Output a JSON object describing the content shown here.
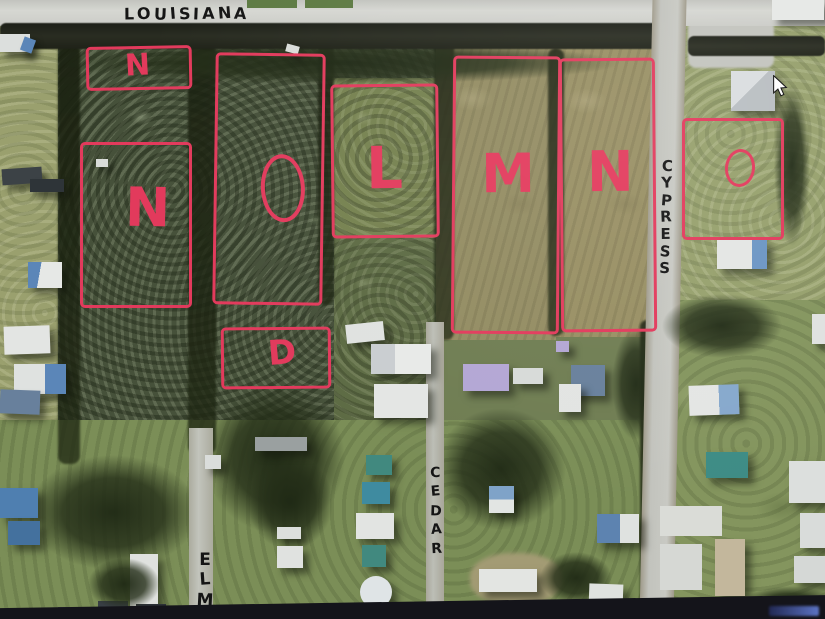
{
  "streets": {
    "louisiana": "LOUISIANA",
    "cypress": "CYPRESS",
    "cedar": "CEDAR",
    "elm": "ELM"
  },
  "plots": [
    {
      "id": "marker-box-north",
      "label": "N"
    },
    {
      "id": "west-large",
      "label": "N"
    },
    {
      "id": "west-tall",
      "label": "O"
    },
    {
      "id": "center",
      "label": "L"
    },
    {
      "id": "field-west",
      "label": "M"
    },
    {
      "id": "field-east",
      "label": "N"
    },
    {
      "id": "east-corner",
      "label": "O"
    },
    {
      "id": "small-box-south",
      "label": "D"
    }
  ],
  "colors": {
    "annotation": "#e23a5c",
    "street_text": "#151515"
  }
}
